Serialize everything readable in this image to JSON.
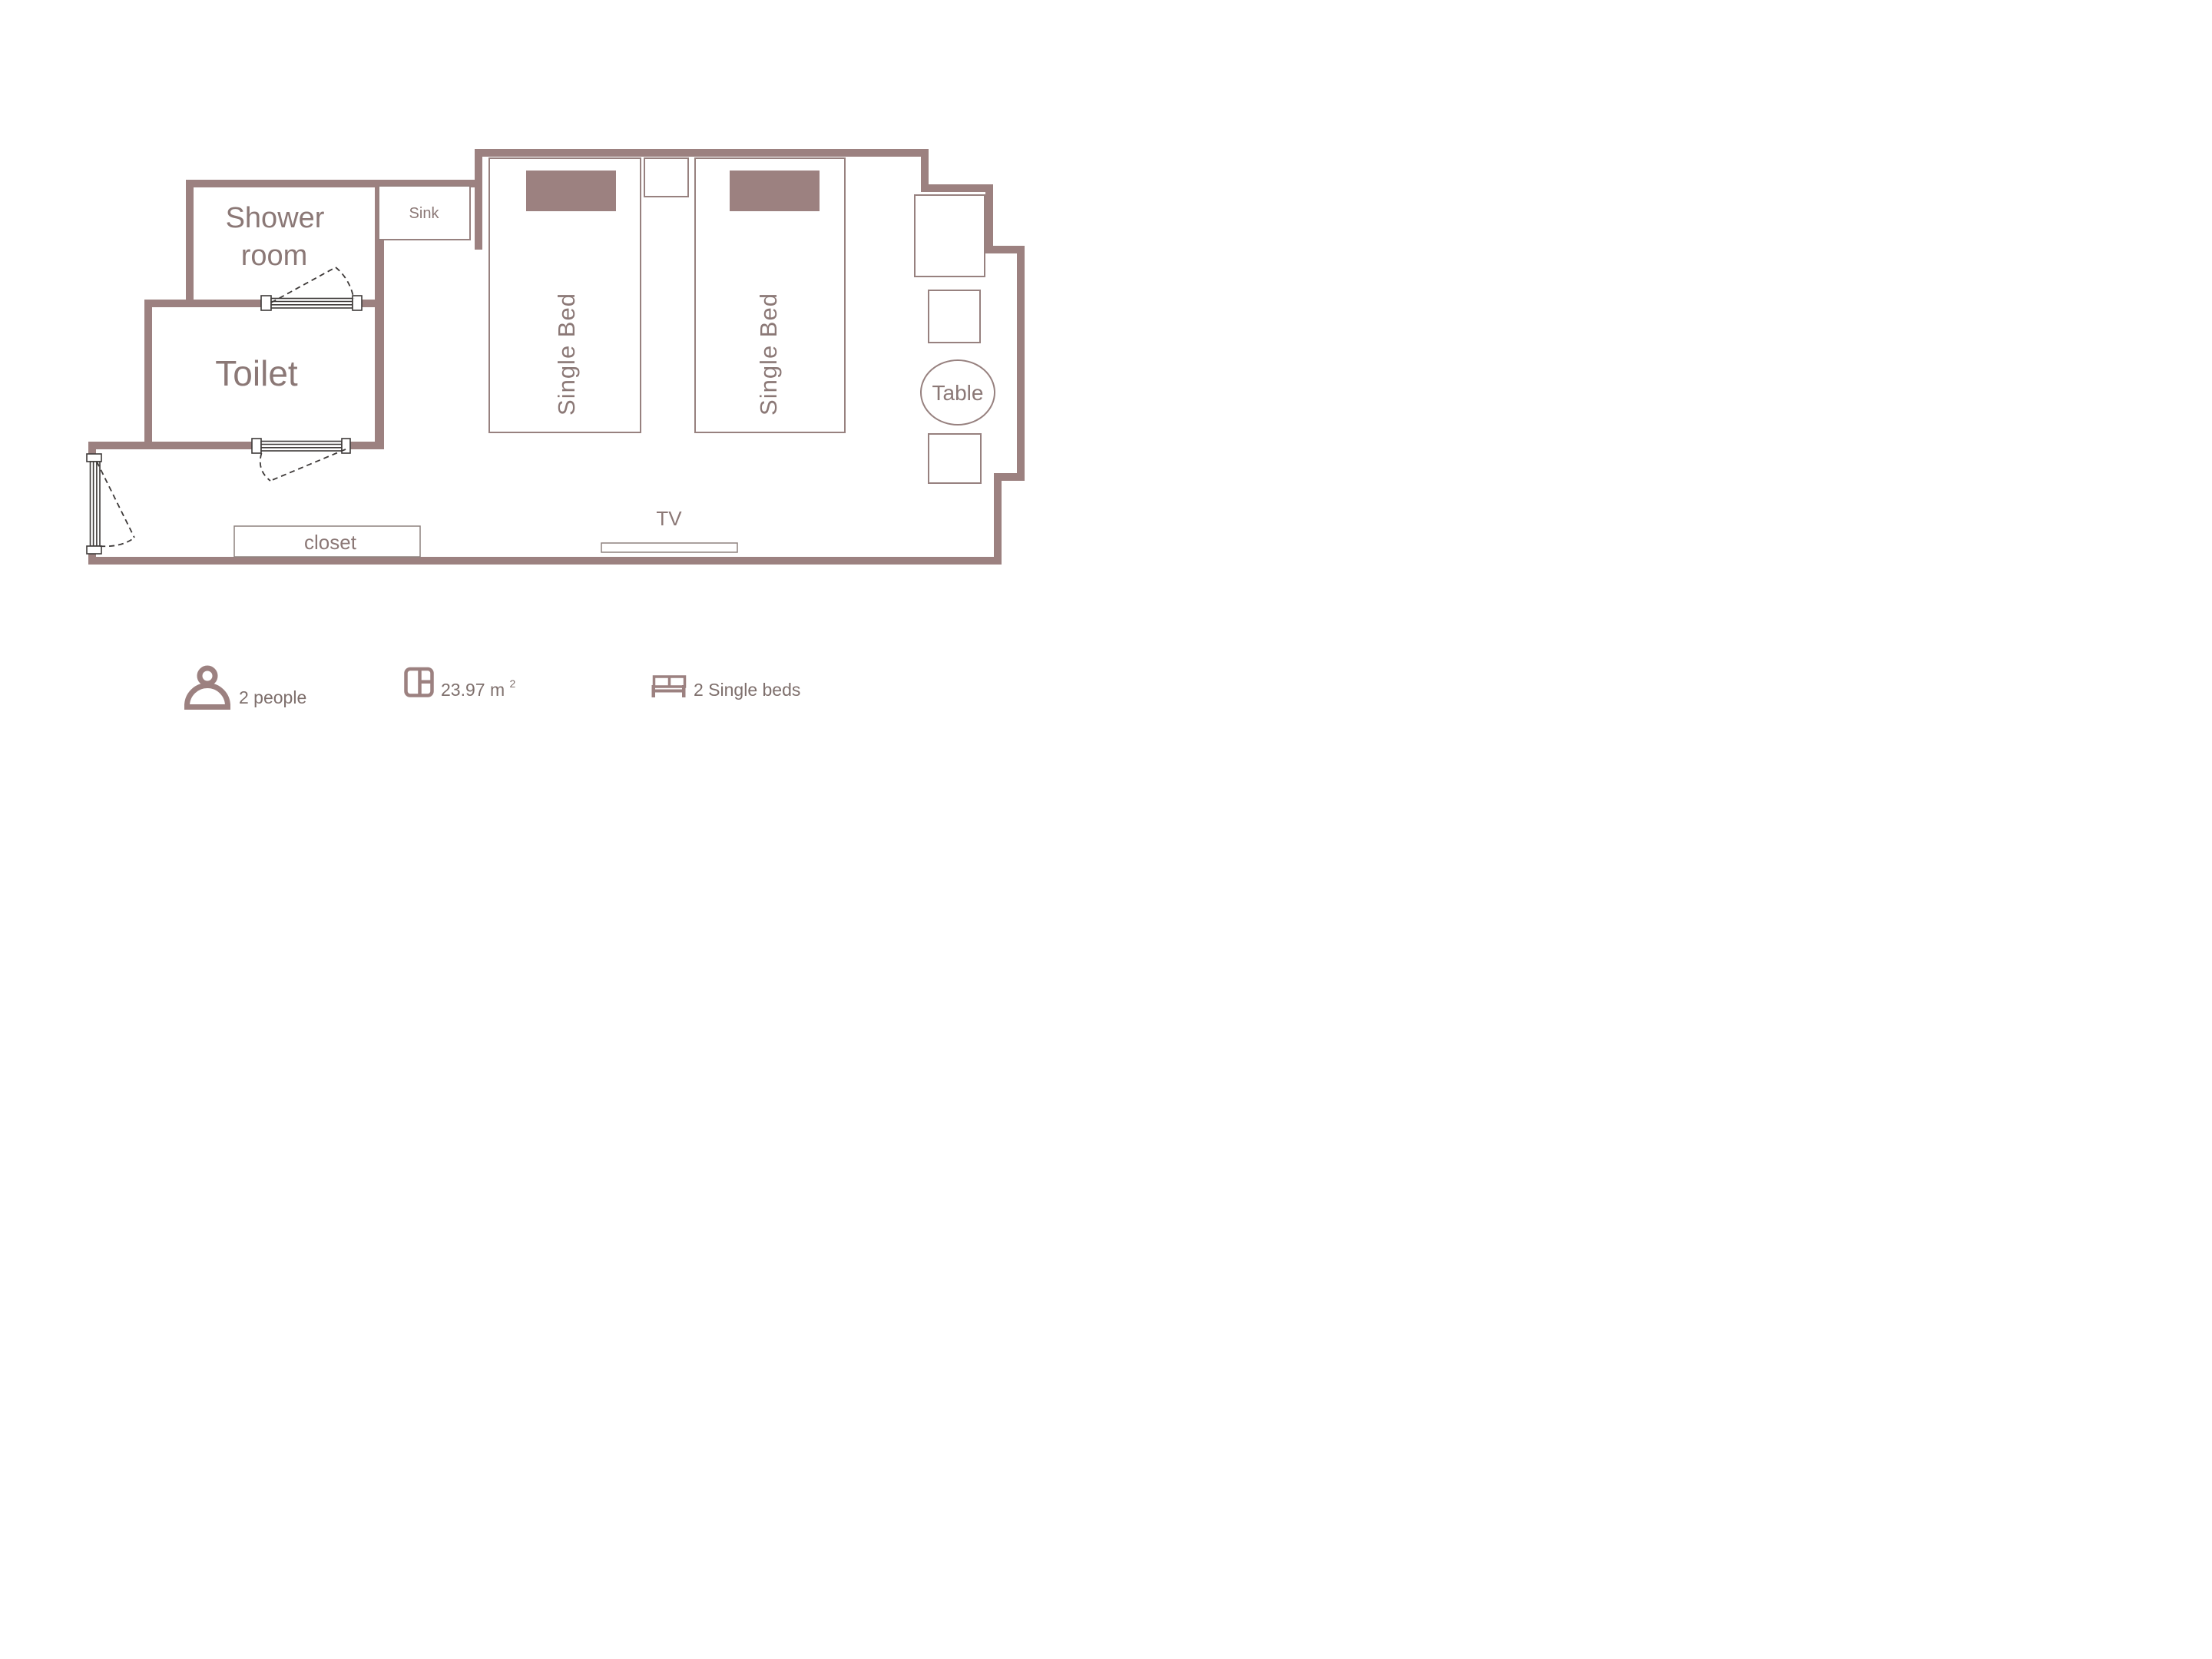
{
  "colors": {
    "wall": "#9c8180",
    "pillow": "#9c8180",
    "furniture_stroke": "#97817f",
    "light_stroke": "#8d827f",
    "door_stroke": "#3e3a39",
    "room_text": "#8b7876",
    "legend_text": "#7e6f6c",
    "background": "#ffffff"
  },
  "rooms": {
    "shower_room": {
      "label_line1": "Shower",
      "label_line2": "room"
    },
    "toilet": {
      "label": "Toilet"
    },
    "sink": {
      "label": "Sink"
    }
  },
  "furniture": {
    "bed_left": {
      "label": "Single Bed"
    },
    "bed_right": {
      "label": "Single Bed"
    },
    "table": {
      "label": "Table"
    },
    "closet": {
      "label": "closet"
    },
    "tv": {
      "label": "TV"
    }
  },
  "legend": {
    "occupancy": {
      "icon": "person-icon",
      "label": "2 people"
    },
    "area": {
      "icon": "floor-plan-icon",
      "value": "23.97",
      "unit": "m",
      "unit_exponent": "2"
    },
    "beds": {
      "icon": "bed-icon",
      "label": "2 Single beds"
    }
  }
}
